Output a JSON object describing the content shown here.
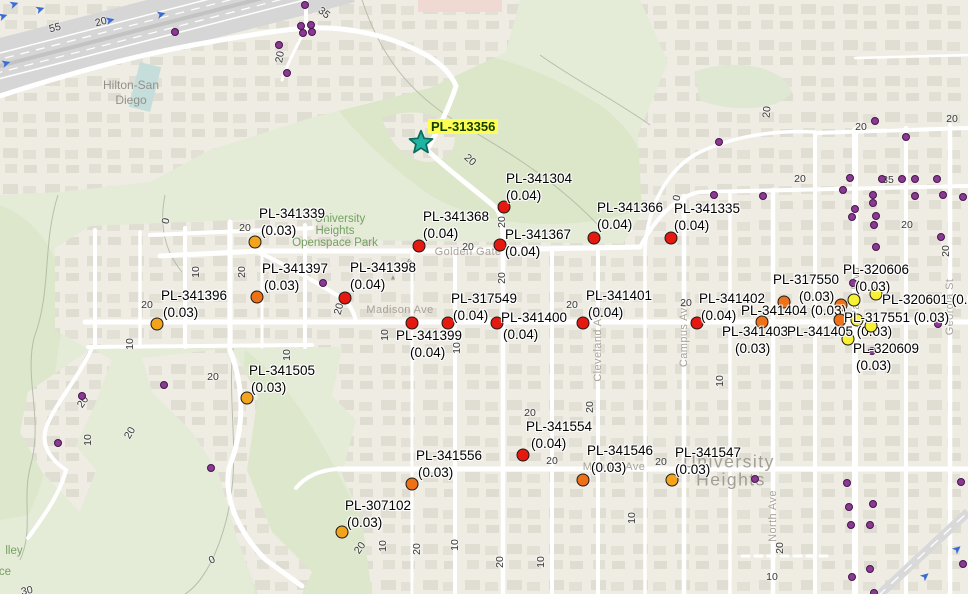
{
  "map": {
    "colors": {
      "red": "#e5190f",
      "orange": "#ee7118",
      "amber": "#f4a41b",
      "yellow": "#f8f032",
      "well": "#8d3894",
      "star_fill": "#1fb3a3",
      "star_stroke": "#0c6a5d",
      "highlight": "#fdfd54"
    },
    "star": {
      "label": "PL-313356",
      "x": 421,
      "y": 142,
      "label_x": 428,
      "label_y": 119
    },
    "markers": [
      {
        "id": "PL-341304",
        "val": "(0.04)",
        "color": "red",
        "dot": [
          504,
          207
        ],
        "lx": 506,
        "ly": 171,
        "d2": 0
      },
      {
        "id": "PL-341368",
        "val": "(0.04)",
        "color": "red",
        "dot": [
          419,
          246
        ],
        "lx": 423,
        "ly": 209,
        "d2": 0
      },
      {
        "id": "PL-341367",
        "val": "(0.04)",
        "color": "red",
        "dot": [
          500,
          245
        ],
        "lx": 505,
        "ly": 227,
        "d2": 0
      },
      {
        "id": "PL-341366",
        "val": "(0.04)",
        "color": "red",
        "dot": [
          594,
          238
        ],
        "lx": 597,
        "ly": 200,
        "d2": 0
      },
      {
        "id": "PL-341335",
        "val": "(0.04)",
        "color": "red",
        "dot": [
          671,
          238
        ],
        "lx": 674,
        "ly": 201,
        "d2": 0
      },
      {
        "id": "PL-341339",
        "val": "(0.03)",
        "color": "amber",
        "dot": [
          255,
          242
        ],
        "lx": 259,
        "ly": 206,
        "d2": 2
      },
      {
        "id": "PL-341397",
        "val": "(0.03)",
        "color": "orange",
        "dot": [
          257,
          297
        ],
        "lx": 262,
        "ly": 261,
        "d2": 2
      },
      {
        "id": "PL-341396",
        "val": "(0.03)",
        "color": "amber",
        "dot": [
          157,
          324
        ],
        "lx": 161,
        "ly": 288,
        "d2": 2
      },
      {
        "id": "PL-341398",
        "val": "(0.04)",
        "color": "red",
        "dot": [
          345,
          298
        ],
        "lx": 350,
        "ly": 260,
        "d2": 0
      },
      {
        "id": "PL-317549",
        "val": "(0.04)",
        "color": "red",
        "dot": [
          448,
          323
        ],
        "lx": 451,
        "ly": 291,
        "d2": 2
      },
      {
        "id": "PL-341399",
        "val": "(0.04)",
        "color": "red",
        "dot": [
          412,
          323
        ],
        "lx": 396,
        "ly": 328,
        "d2": 14
      },
      {
        "id": "PL-341400",
        "val": "(0.04)",
        "color": "red",
        "dot": [
          497,
          323
        ],
        "lx": 501,
        "ly": 310,
        "d2": 2
      },
      {
        "id": "PL-341401",
        "val": "(0.04)",
        "color": "red",
        "dot": [
          583,
          323
        ],
        "lx": 586,
        "ly": 288,
        "d2": 2
      },
      {
        "id": "PL-341402",
        "val": "(0.04)",
        "color": "red",
        "dot": [
          697,
          323
        ],
        "lx": 699,
        "ly": 291,
        "d2": 2
      },
      {
        "id": "PL-317550",
        "val": "(0.03)",
        "color": "orange",
        "dot": [
          784,
          302
        ],
        "lx": 773,
        "ly": 272,
        "d2": 26
      },
      {
        "id": "PL-341404",
        "val": "(0.03)",
        "color": "orange",
        "dot": [
          762,
          322
        ],
        "lx": 741,
        "ly": 303,
        "single": true
      },
      {
        "id": "PL-341403",
        "val": "(0.03)",
        "color": "orange",
        "dot": [
          840,
          320
        ],
        "lx": 722,
        "ly": 324,
        "d2": 13
      },
      {
        "id": "PL-341405",
        "val": "(0.03)",
        "color": "yellow",
        "dot": [
          848,
          339
        ],
        "lx": 787,
        "ly": 324,
        "single": true
      },
      {
        "id": "PL-320606",
        "val": "(0.03)",
        "color": "yellow",
        "dot": [
          876,
          294
        ],
        "lx": 843,
        "ly": 262,
        "d2": 12
      },
      {
        "id": "PL-320601",
        "val": "(0.03)",
        "color": "yellow",
        "dot": [
          854,
          300
        ],
        "lx": 882,
        "ly": 292,
        "single": true
      },
      {
        "id": "PL-317551",
        "val": "(0.03)",
        "color": "yellow",
        "dot": [
          871,
          326
        ],
        "lx": 844,
        "ly": 310,
        "single": true
      },
      {
        "id": "PL-320609",
        "val": "(0.03)",
        "color": "yellow",
        "dot": null,
        "lx": 853,
        "ly": 341,
        "d2": 3
      },
      {
        "id": "PL-341554",
        "val": "(0.04)",
        "color": "red",
        "dot": [
          523,
          455
        ],
        "lx": 526,
        "ly": 419,
        "d2": 5
      },
      {
        "id": "PL-341556",
        "val": "(0.03)",
        "color": "orange",
        "dot": [
          412,
          484
        ],
        "lx": 416,
        "ly": 448,
        "d2": 2
      },
      {
        "id": "PL-341546",
        "val": "(0.03)",
        "color": "orange",
        "dot": [
          583,
          480
        ],
        "lx": 587,
        "ly": 443,
        "d2": 4
      },
      {
        "id": "PL-341547",
        "val": "(0.03)",
        "color": "amber",
        "dot": [
          672,
          480
        ],
        "lx": 675,
        "ly": 445,
        "d2": 0
      },
      {
        "id": "PL-307102",
        "val": "(0.03)",
        "color": "amber",
        "dot": [
          342,
          532
        ],
        "lx": 345,
        "ly": 498,
        "d2": 2
      },
      {
        "id": "PL-341505",
        "val": "(0.03)",
        "color": "amber",
        "dot": [
          247,
          398
        ],
        "lx": 249,
        "ly": 363,
        "d2": 2
      }
    ],
    "extra_dots": [
      {
        "c": "orange",
        "x": 841,
        "y": 305
      },
      {
        "c": "yellow",
        "x": 857,
        "y": 320
      }
    ],
    "wells": [
      [
        175,
        32
      ],
      [
        305,
        5
      ],
      [
        301,
        26
      ],
      [
        311,
        25
      ],
      [
        303,
        33
      ],
      [
        312,
        32
      ],
      [
        279,
        45
      ],
      [
        287,
        73
      ],
      [
        719,
        142
      ],
      [
        875,
        121
      ],
      [
        906,
        137
      ],
      [
        850,
        178
      ],
      [
        882,
        179
      ],
      [
        902,
        179
      ],
      [
        915,
        179
      ],
      [
        937,
        179
      ],
      [
        714,
        195
      ],
      [
        763,
        196
      ],
      [
        843,
        190
      ],
      [
        873,
        195
      ],
      [
        915,
        196
      ],
      [
        943,
        195
      ],
      [
        963,
        197
      ],
      [
        873,
        203
      ],
      [
        855,
        209
      ],
      [
        852,
        217
      ],
      [
        876,
        216
      ],
      [
        874,
        225
      ],
      [
        876,
        247
      ],
      [
        941,
        237
      ],
      [
        323,
        283
      ],
      [
        853,
        283
      ],
      [
        938,
        324
      ],
      [
        872,
        351
      ],
      [
        164,
        385
      ],
      [
        82,
        396
      ],
      [
        58,
        443
      ],
      [
        211,
        468
      ],
      [
        755,
        479
      ],
      [
        847,
        483
      ],
      [
        961,
        482
      ],
      [
        849,
        507
      ],
      [
        873,
        504
      ],
      [
        851,
        525
      ],
      [
        870,
        525
      ],
      [
        870,
        569
      ],
      [
        852,
        577
      ],
      [
        963,
        564
      ],
      [
        874,
        593
      ]
    ],
    "contour_labels": [
      {
        "t": "55",
        "x": 55,
        "y": 28,
        "r": -14
      },
      {
        "t": "20",
        "x": 101,
        "y": 22,
        "r": -14
      },
      {
        "t": "35",
        "x": 324,
        "y": 13,
        "r": 38
      },
      {
        "t": "20",
        "x": 280,
        "y": 57,
        "r": -80
      },
      {
        "t": "20",
        "x": 470,
        "y": 160,
        "r": 42
      },
      {
        "t": "20",
        "x": 245,
        "y": 228,
        "r": 0
      },
      {
        "t": "0",
        "x": 166,
        "y": 221,
        "r": -80
      },
      {
        "t": "10",
        "x": 196,
        "y": 272,
        "r": -90
      },
      {
        "t": "20",
        "x": 242,
        "y": 272,
        "r": -90
      },
      {
        "t": "20",
        "x": 147,
        "y": 305,
        "r": 0
      },
      {
        "t": "10",
        "x": 130,
        "y": 344,
        "r": -90
      },
      {
        "t": "20",
        "x": 83,
        "y": 402,
        "r": -55
      },
      {
        "t": "20",
        "x": 130,
        "y": 433,
        "r": -60
      },
      {
        "t": "10",
        "x": 88,
        "y": 440,
        "r": -90
      },
      {
        "t": "20",
        "x": 213,
        "y": 377,
        "r": 0
      },
      {
        "t": "10",
        "x": 287,
        "y": 355,
        "r": -90
      },
      {
        "t": "20",
        "x": 502,
        "y": 222,
        "r": -90
      },
      {
        "t": "20",
        "x": 468,
        "y": 247,
        "r": 0
      },
      {
        "t": "20",
        "x": 502,
        "y": 278,
        "r": -90
      },
      {
        "t": "10",
        "x": 385,
        "y": 335,
        "r": -90
      },
      {
        "t": "10",
        "x": 457,
        "y": 348,
        "r": -90
      },
      {
        "t": "20",
        "x": 339,
        "y": 309,
        "r": -75
      },
      {
        "t": "20",
        "x": 572,
        "y": 305,
        "r": 0
      },
      {
        "t": "20",
        "x": 686,
        "y": 303,
        "r": 0
      },
      {
        "t": "20",
        "x": 767,
        "y": 112,
        "r": -85
      },
      {
        "t": "20",
        "x": 861,
        "y": 127,
        "r": 0
      },
      {
        "t": "20",
        "x": 952,
        "y": 119,
        "r": 0
      },
      {
        "t": "20",
        "x": 800,
        "y": 179,
        "r": 0
      },
      {
        "t": "35",
        "x": 888,
        "y": 180,
        "r": 0
      },
      {
        "t": "20",
        "x": 907,
        "y": 225,
        "r": 0
      },
      {
        "t": "20",
        "x": 946,
        "y": 251,
        "r": -90
      },
      {
        "t": "0",
        "x": 677,
        "y": 198,
        "r": -80
      },
      {
        "t": "10",
        "x": 720,
        "y": 381,
        "r": -90
      },
      {
        "t": "20",
        "x": 530,
        "y": 413,
        "r": 0
      },
      {
        "t": "20",
        "x": 590,
        "y": 407,
        "r": -90
      },
      {
        "t": "20",
        "x": 552,
        "y": 461,
        "r": 0
      },
      {
        "t": "20",
        "x": 661,
        "y": 462,
        "r": 0
      },
      {
        "t": "10",
        "x": 632,
        "y": 518,
        "r": -90
      },
      {
        "t": "20",
        "x": 360,
        "y": 548,
        "r": -55
      },
      {
        "t": "10",
        "x": 383,
        "y": 546,
        "r": -90
      },
      {
        "t": "20",
        "x": 417,
        "y": 549,
        "r": -90
      },
      {
        "t": "10",
        "x": 455,
        "y": 545,
        "r": -90
      },
      {
        "t": "20",
        "x": 500,
        "y": 562,
        "r": -90
      },
      {
        "t": "10",
        "x": 541,
        "y": 562,
        "r": -90
      },
      {
        "t": "20",
        "x": 780,
        "y": 548,
        "r": -90
      },
      {
        "t": "10",
        "x": 772,
        "y": 577,
        "r": 0
      },
      {
        "t": "0",
        "x": 212,
        "y": 560,
        "r": -25
      },
      {
        "t": "30",
        "x": 27,
        "y": 591,
        "r": -12
      }
    ],
    "street_labels": [
      {
        "t": "Madison Ave",
        "x": 400,
        "y": 310,
        "r": 0
      },
      {
        "t": "Golden Gate Dr",
        "x": 476,
        "y": 252,
        "r": 0
      },
      {
        "t": "Monroe Ave",
        "x": 614,
        "y": 467,
        "r": 0
      },
      {
        "t": "Cleveland Ave",
        "x": 598,
        "y": 344,
        "r": -90
      },
      {
        "t": "Campus Ave",
        "x": 684,
        "y": 334,
        "r": -90
      },
      {
        "t": "Park Blvd",
        "x": 856,
        "y": 292,
        "r": -90
      },
      {
        "t": "Georgia St",
        "x": 950,
        "y": 307,
        "r": -90
      },
      {
        "t": "North Ave",
        "x": 773,
        "y": 516,
        "r": -90
      }
    ],
    "place_labels": [
      {
        "t": "Hilton-San",
        "x": 131,
        "y": 85,
        "cls": "poi"
      },
      {
        "t": "Diego",
        "x": 131,
        "y": 100,
        "cls": "poi"
      },
      {
        "t": "University",
        "x": 340,
        "y": 219,
        "cls": "park"
      },
      {
        "t": "Heights",
        "x": 335,
        "y": 231,
        "cls": "park"
      },
      {
        "t": "Openspace Park",
        "x": 335,
        "y": 243,
        "cls": "park"
      },
      {
        "t": "University",
        "x": 729,
        "y": 462,
        "cls": "big"
      },
      {
        "t": "Heights",
        "x": 731,
        "y": 480,
        "cls": "big"
      },
      {
        "t": "lley",
        "x": 14,
        "y": 551,
        "cls": "park"
      },
      {
        "t": "ce",
        "x": 5,
        "y": 572,
        "cls": "park"
      },
      {
        "t": "ft",
        "x": 409,
        "y": 264,
        "cls": "peak"
      }
    ],
    "arrows": [
      {
        "x": 14,
        "y": 4,
        "r": -18
      },
      {
        "x": 40,
        "y": 9,
        "r": -18
      },
      {
        "x": 3,
        "y": 16,
        "r": -18
      },
      {
        "x": 110,
        "y": 20,
        "r": -14
      },
      {
        "x": 161,
        "y": 14,
        "r": -14
      },
      {
        "x": 6,
        "y": 63,
        "r": -16
      },
      {
        "x": 925,
        "y": 576,
        "r": -40
      },
      {
        "x": 957,
        "y": 549,
        "r": -40
      }
    ]
  }
}
